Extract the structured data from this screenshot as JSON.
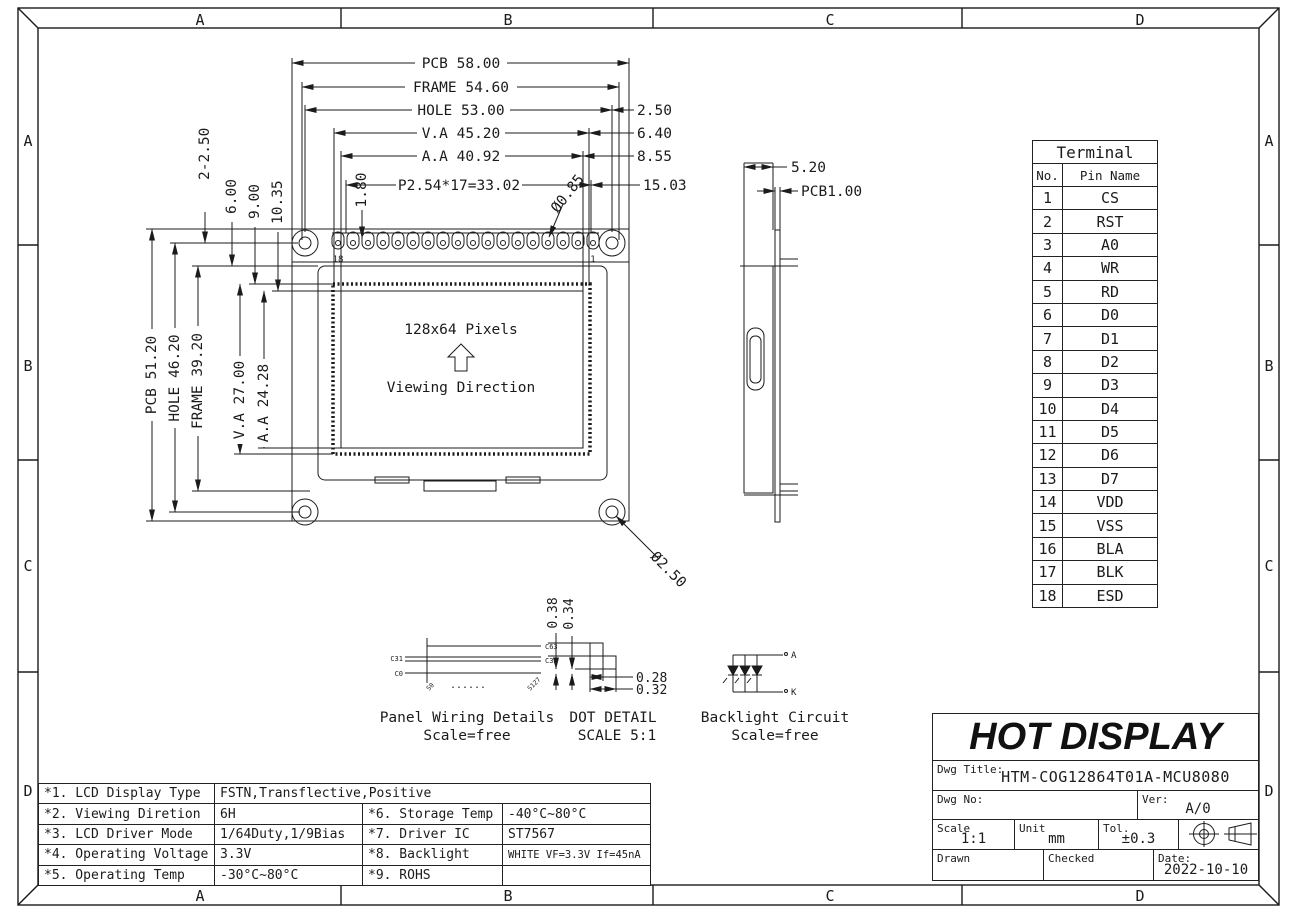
{
  "border": {
    "top": [
      "A",
      "B",
      "C",
      "D"
    ],
    "bottom": [
      "A",
      "B",
      "C",
      "D"
    ],
    "left": [
      "A",
      "B",
      "C",
      "D"
    ],
    "right": [
      "A",
      "B",
      "C",
      "D"
    ]
  },
  "front_view": {
    "dim_pcb_w": "PCB 58.00",
    "dim_frame_w": "FRAME 54.60",
    "dim_hole_w": "HOLE 53.00",
    "dim_va_w": "V.A 45.20",
    "dim_aa_w": "A.A 40.92",
    "dim_pitch": "P2.54*17=33.02",
    "dim_off_hole": "2.50",
    "dim_off_va": "6.40",
    "dim_off_aa": "8.55",
    "dim_off_pitch": "15.03",
    "dim_pin_w": "1.80",
    "dim_pin_hole": "Ø0.85",
    "dim_corner_holes": "2-2.50",
    "dim_top_frame": "6.00",
    "dim_top_va": "9.00",
    "dim_top_aa": "10.35",
    "dim_pcb_h": "PCB 51.20",
    "dim_hole_h": "HOLE 46.20",
    "dim_frame_h": "FRAME 39.20",
    "dim_va_h": "V.A 27.00",
    "dim_aa_h": "A.A 24.28",
    "dim_mount_hole": "Ø2.50",
    "pin_label_left": "18",
    "pin_label_right": "1",
    "display_res": "128x64 Pixels",
    "viewing_dir": "Viewing Direction"
  },
  "side_view": {
    "dim_width": "5.20",
    "dim_pcb": "PCB1.00"
  },
  "panel_wiring": {
    "caption": "Panel Wiring Details",
    "scale": "Scale=free",
    "label_c63": "C63",
    "label_c32": "C32",
    "label_c31": "C31",
    "label_c0": "C0",
    "label_s0": "S0",
    "label_s127": "S127",
    "dots": "......"
  },
  "dot_detail": {
    "caption": "DOT DETAIL",
    "scale": "SCALE 5:1",
    "dim_h1": "0.38",
    "dim_h2": "0.34",
    "dim_w1": "0.28",
    "dim_w2": "0.32"
  },
  "backlight": {
    "caption": "Backlight Circuit",
    "scale": "Scale=free",
    "anode": "A",
    "cathode": "K"
  },
  "terminal_table": {
    "title": "Terminal",
    "col_no": "No.",
    "col_name": "Pin Name",
    "pins": [
      {
        "no": "1",
        "name": "CS"
      },
      {
        "no": "2",
        "name": "RST"
      },
      {
        "no": "3",
        "name": "A0"
      },
      {
        "no": "4",
        "name": "WR"
      },
      {
        "no": "5",
        "name": "RD"
      },
      {
        "no": "6",
        "name": "D0"
      },
      {
        "no": "7",
        "name": "D1"
      },
      {
        "no": "8",
        "name": "D2"
      },
      {
        "no": "9",
        "name": "D3"
      },
      {
        "no": "10",
        "name": "D4"
      },
      {
        "no": "11",
        "name": "D5"
      },
      {
        "no": "12",
        "name": "D6"
      },
      {
        "no": "13",
        "name": "D7"
      },
      {
        "no": "14",
        "name": "VDD"
      },
      {
        "no": "15",
        "name": "VSS"
      },
      {
        "no": "16",
        "name": "BLA"
      },
      {
        "no": "17",
        "name": "BLK"
      },
      {
        "no": "18",
        "name": "ESD"
      }
    ]
  },
  "spec_table": {
    "row1_label": "*1. LCD Display Type",
    "row1_value": "FSTN,Transflective,Positive",
    "rows": [
      {
        "l1": "*2. Viewing Diretion",
        "v1": "6H",
        "l2": "*6. Storage Temp",
        "v2": "-40°C~80°C"
      },
      {
        "l1": "*3. LCD Driver Mode",
        "v1": "1/64Duty,1/9Bias",
        "l2": "*7. Driver IC",
        "v2": "ST7567"
      },
      {
        "l1": "*4. Operating Voltage",
        "v1": "3.3V",
        "l2": "*8. Backlight",
        "v2": "WHITE VF=3.3V If=45nA"
      },
      {
        "l1": "*5. Operating Temp",
        "v1": "-30°C~80°C",
        "l2": "*9. ROHS",
        "v2": ""
      }
    ]
  },
  "title_block": {
    "logo": "HOT DISPLAY",
    "dwg_title_label": "Dwg Title:",
    "dwg_title": "HTM-COG12864T01A-MCU8080",
    "dwg_no_label": "Dwg No:",
    "ver_label": "Ver:",
    "ver": "A/0",
    "scale_label": "Scale",
    "scale": "1:1",
    "unit_label": "Unit",
    "unit": "mm",
    "tol_label": "Tol.",
    "tol": "±0.3",
    "drawn_label": "Drawn",
    "checked_label": "Checked",
    "date_label": "Date:",
    "date": "2022-10-10"
  }
}
